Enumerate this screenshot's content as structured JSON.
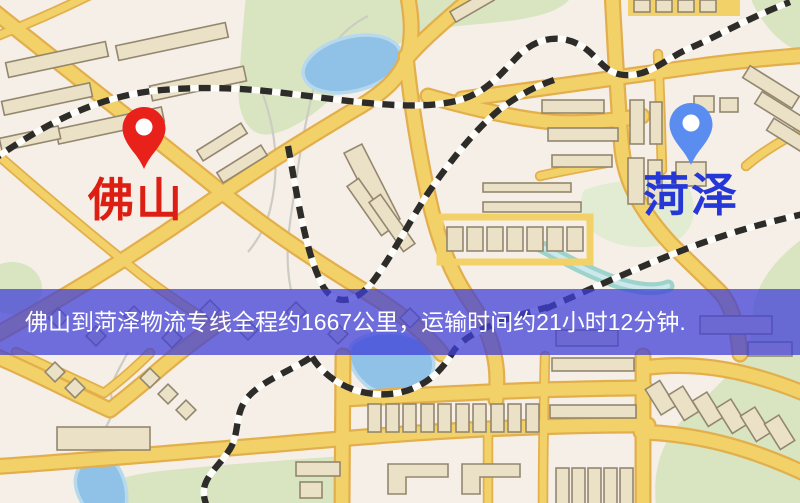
{
  "map": {
    "origin": {
      "name": "佛山"
    },
    "destination": {
      "name": "菏泽"
    },
    "banner": {
      "text": "佛山到菏泽物流专线全程约1667公里，运输时间约21小时12分钟."
    },
    "route": {
      "distance_km": "1667",
      "duration_hours": "21",
      "duration_minutes": "12"
    }
  },
  "colors": {
    "map_bg": "#f6efe8",
    "road_fill": "#f3d169",
    "road_edge": "#e2af4c",
    "building_fill": "#eae1c6",
    "building_edge": "#93876f",
    "park": "#d8e5c0",
    "park_light": "#e2ecd2",
    "water": "#90c2e8",
    "water_edge": "#b6d9ee",
    "river": "#9ed3cb",
    "river_light": "#cbe8ec",
    "stream": "#cdccc4",
    "rail": "#2e2c29",
    "rail_light": "#fdfdfa",
    "banner_bg": "#3f3fd8",
    "banner_text": "#ffffff",
    "origin_pin": "#e8221a",
    "origin_label": "#dd1e12",
    "dest_pin": "#5b8cf0",
    "dest_label": "#2537d6",
    "pin_hole": "#ffffff"
  }
}
